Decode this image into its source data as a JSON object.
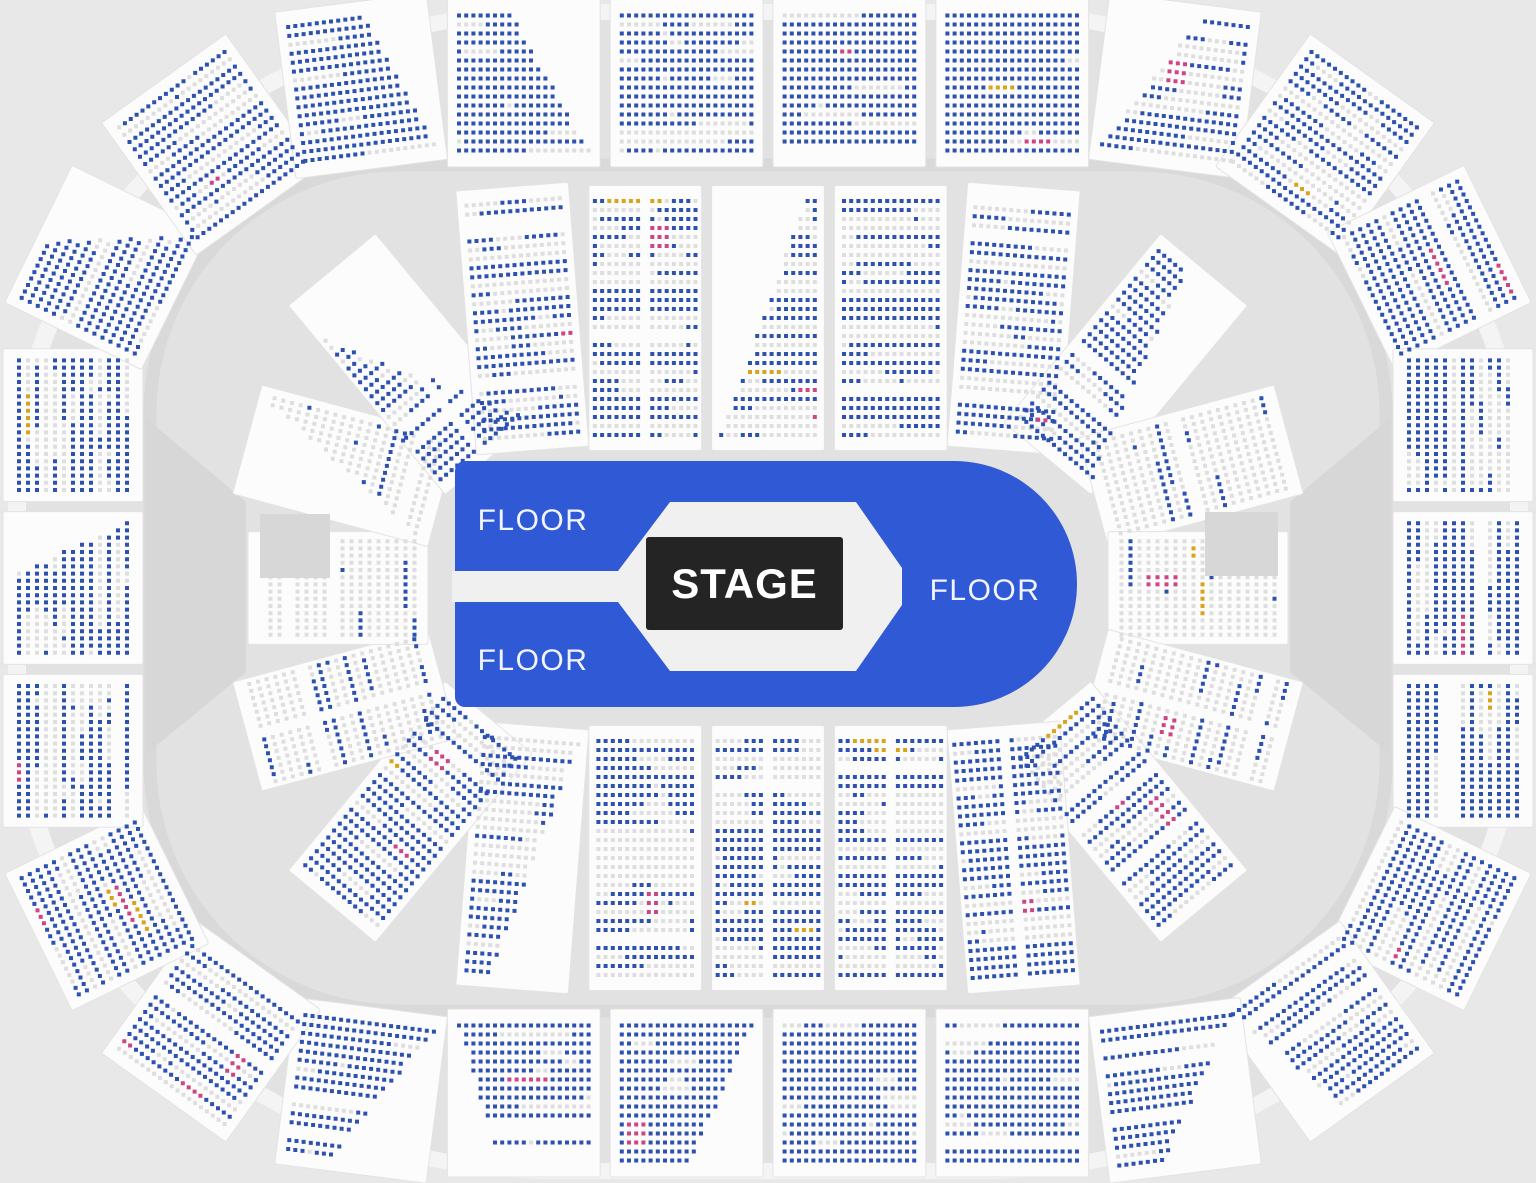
{
  "map": {
    "canvas": {
      "width": 1536,
      "height": 1183
    },
    "center": {
      "x": 768,
      "y": 588
    },
    "colors": {
      "page_bg": "#e8e8e8",
      "concourse": "#f4f4f4",
      "bowl": "#e2e2e2",
      "walkway": "#d9d9d9",
      "wedge": "#d7d7d7",
      "section_fill": "#fcfcfc",
      "section_stroke": "#e3e3e3"
    },
    "seat_colors": {
      "available": "#2d51b0",
      "unavailable": "#dedede",
      "resale": "#ce4584",
      "special": "#d9a41b"
    },
    "seat": {
      "size": 4,
      "pitch_x": 7.2,
      "pitch_y": 9
    },
    "concourse": {
      "x": 8,
      "y": 4,
      "width": 1520,
      "height": 1175,
      "rx": 545,
      "ry": 485
    },
    "bowl": {
      "x": 26,
      "y": 20,
      "width": 1484,
      "height": 1143,
      "rx": 525,
      "ry": 468
    },
    "walkway": {
      "x": 150,
      "y": 165,
      "width": 1236,
      "height": 846,
      "radius": 248,
      "stroke_width": 13
    },
    "rings": [
      {
        "name": "outer",
        "half_width": 695,
        "half_height": 505,
        "corner_radius": 330,
        "sections": 26,
        "gap": 10,
        "depth_min": 140,
        "depth_max": 168,
        "avail_base": 0.55,
        "avail_rand": 0.3,
        "avail_vertical": 0.1,
        "avail_corner": 0.0,
        "end_factor": 1.0,
        "aisles": false
      },
      {
        "name": "lower",
        "half_width": 430,
        "half_height": 270,
        "corner_radius": 200,
        "sections": 20,
        "gap": 10,
        "depth_min": 180,
        "depth_max": 265,
        "avail_base": 0.16,
        "avail_rand": 0.15,
        "avail_vertical": 0.28,
        "avail_corner": 0.3,
        "end_factor": 0.45,
        "aisles": true
      }
    ],
    "wedges": [
      [
        [
          146,
          418
        ],
        [
          246,
          502
        ],
        [
          246,
          672
        ],
        [
          146,
          754
        ]
      ],
      [
        [
          1390,
          418
        ],
        [
          1290,
          502
        ],
        [
          1290,
          672
        ],
        [
          1390,
          754
        ]
      ]
    ],
    "suites": [
      [
        [
          1205,
          512
        ],
        [
          1278,
          512
        ],
        [
          1278,
          576
        ],
        [
          1205,
          576
        ]
      ],
      [
        [
          260,
          514
        ],
        [
          330,
          514
        ],
        [
          330,
          578
        ],
        [
          260,
          578
        ]
      ]
    ],
    "seed": 1337
  },
  "floor": {
    "fill": "#3059d6",
    "cutout_color": "#f0f0f0",
    "rect": {
      "x": 455,
      "y": 461,
      "width": 622,
      "height": 246,
      "left_radius": 10,
      "right_radius": 123
    },
    "slot": {
      "x": 452,
      "y": 571,
      "width": 172,
      "height": 31
    },
    "hexagon": [
      [
        618,
        571
      ],
      [
        670,
        502
      ],
      [
        856,
        502
      ],
      [
        902,
        568
      ],
      [
        902,
        605
      ],
      [
        856,
        671
      ],
      [
        670,
        671
      ],
      [
        618,
        602
      ]
    ],
    "stage": {
      "label": "STAGE",
      "x": 646,
      "y": 537,
      "width": 197,
      "height": 93,
      "fill": "#242424",
      "text_color": "#ffffff"
    },
    "labels": [
      {
        "text": "FLOOR",
        "x": 533,
        "y": 521
      },
      {
        "text": "FLOOR",
        "x": 533,
        "y": 661
      },
      {
        "text": "FLOOR",
        "x": 985,
        "y": 591
      }
    ]
  }
}
